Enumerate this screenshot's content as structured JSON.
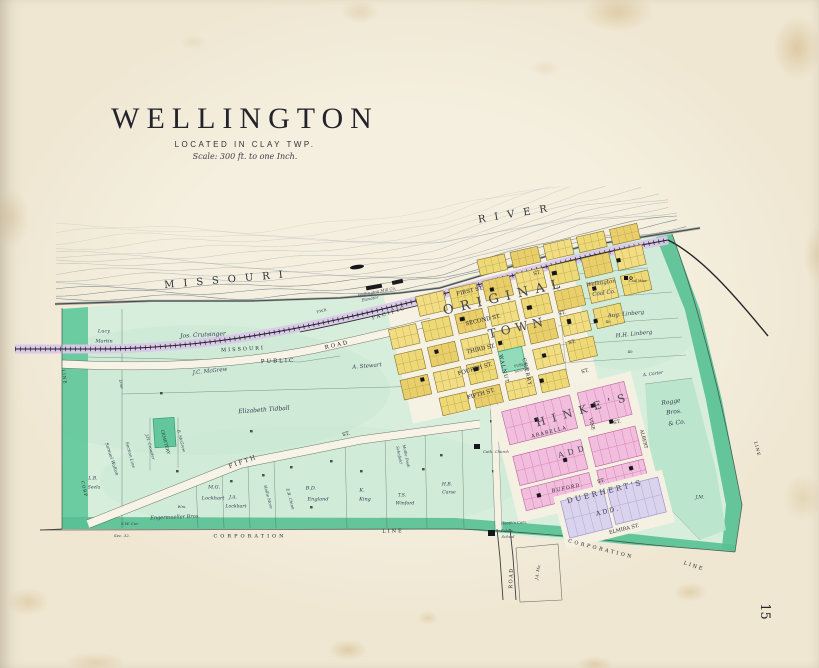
{
  "page": {
    "number": "15"
  },
  "title": {
    "main": "WELLINGTON",
    "located": "LOCATED IN CLAY TWP.",
    "scale": "Scale: 300 ft. to one Inch."
  },
  "map": {
    "colors": {
      "paper": "#f2ebda",
      "water_line": "#86959c",
      "land_green": "#d8eedd",
      "corp_band_green": "#58c094",
      "railroad_band": "#d9c8e8",
      "town_block_yellow": "#eed977",
      "hinkes_pink": "#f2bedd",
      "duerherts_lavender": "#dad3ee",
      "public_square_green": "#93dcbb",
      "cemetery_green": "#63c79b",
      "building_black": "#15151a"
    },
    "labels": [
      {
        "id": "missouri-river",
        "t": "MISSOURI",
        "x": 228,
        "y": 280,
        "r": -5,
        "s": 10,
        "ls": 9,
        "cls": "river"
      },
      {
        "id": "river",
        "t": "RIVER",
        "x": 517,
        "y": 214,
        "r": -9,
        "s": 10,
        "ls": 9,
        "cls": "river"
      },
      {
        "id": "rr-missouri",
        "t": "MISSOURI",
        "x": 243,
        "y": 349,
        "r": -3,
        "s": 5,
        "ls": 2,
        "cls": "small-caps"
      },
      {
        "id": "rr-pacific",
        "t": "PACIFIC",
        "x": 389,
        "y": 313,
        "r": -17,
        "s": 5,
        "ls": 2,
        "cls": "small-caps"
      },
      {
        "id": "fwb",
        "t": "F.W.B.",
        "x": 322,
        "y": 311,
        "r": -15,
        "s": 3.6,
        "cls": "tiny"
      },
      {
        "id": "public-road-1",
        "t": "PUBLIC",
        "x": 278,
        "y": 361,
        "r": -2,
        "s": 5.5,
        "ls": 2,
        "cls": "small-caps"
      },
      {
        "id": "public-road-2",
        "t": "ROAD",
        "x": 337,
        "y": 345,
        "r": -13,
        "s": 5.5,
        "ls": 2,
        "cls": "small-caps"
      },
      {
        "id": "mill",
        "t": "Wellington Mill Co.",
        "x": 377,
        "y": 292,
        "r": -11,
        "s": 4,
        "cls": "tiny-italic"
      },
      {
        "id": "elevator",
        "t": "Elevator",
        "x": 370,
        "y": 299,
        "r": -11,
        "s": 4,
        "cls": "tiny-italic"
      },
      {
        "id": "original",
        "t": "ORIGINAL",
        "x": 505,
        "y": 297,
        "r": -13,
        "s": 13,
        "ls": 7,
        "cls": "bigname"
      },
      {
        "id": "town",
        "t": "TOWN",
        "x": 518,
        "y": 328,
        "r": -13,
        "s": 12,
        "ls": 5,
        "cls": "bigname"
      },
      {
        "id": "st-top",
        "t": "ST.",
        "x": 537,
        "y": 273,
        "r": -13,
        "s": 5,
        "cls": "street"
      },
      {
        "id": "first-st",
        "t": "FIRST ST.",
        "x": 470,
        "y": 291,
        "r": -13,
        "s": 5.5,
        "cls": "street"
      },
      {
        "id": "second-st",
        "t": "SECOND ST.",
        "x": 483,
        "y": 320,
        "r": -13,
        "s": 5.5,
        "cls": "street"
      },
      {
        "id": "third-st",
        "t": "THIRD ST.",
        "x": 481,
        "y": 349,
        "r": -13,
        "s": 5.5,
        "cls": "street"
      },
      {
        "id": "fourth-st",
        "t": "FOURTH ST.",
        "x": 475,
        "y": 369,
        "r": -16,
        "s": 5.5,
        "cls": "street"
      },
      {
        "id": "fifth-st-town",
        "t": "FIFTH ST.",
        "x": 481,
        "y": 394,
        "r": -16,
        "s": 5.5,
        "cls": "street"
      },
      {
        "id": "st-2",
        "t": "ST.",
        "x": 562,
        "y": 313,
        "r": -13,
        "s": 5,
        "cls": "street"
      },
      {
        "id": "st-3",
        "t": "ST.",
        "x": 572,
        "y": 342,
        "r": -13,
        "s": 5,
        "cls": "street"
      },
      {
        "id": "st-4",
        "t": "ST.",
        "x": 585,
        "y": 371,
        "r": -13,
        "s": 5,
        "cls": "street"
      },
      {
        "id": "walnut",
        "t": "WALNUT",
        "x": 504,
        "y": 369,
        "r": 77,
        "s": 5,
        "ls": 1,
        "cls": "street"
      },
      {
        "id": "cherry",
        "t": "CHERRY",
        "x": 527,
        "y": 372,
        "r": 77,
        "s": 5,
        "ls": 1,
        "cls": "street"
      },
      {
        "id": "public-square-1",
        "t": "PUBLIC",
        "x": 521,
        "y": 365,
        "r": -13,
        "s": 3.4,
        "cls": "tiny"
      },
      {
        "id": "public-square-2",
        "t": "SQUARE",
        "x": 522,
        "y": 370,
        "r": -13,
        "s": 3.4,
        "cls": "tiny"
      },
      {
        "id": "lucy",
        "t": "Lucy",
        "x": 104,
        "y": 331,
        "s": 5,
        "cls": "name"
      },
      {
        "id": "martin",
        "t": "Martin",
        "x": 104,
        "y": 341,
        "s": 5,
        "cls": "name"
      },
      {
        "id": "crutsinger",
        "t": "Jos. Crutsinger",
        "x": 203,
        "y": 335,
        "r": -3,
        "s": 6,
        "cls": "name"
      },
      {
        "id": "mcgrew",
        "t": "J.C. McGrew",
        "x": 210,
        "y": 371,
        "r": -6,
        "s": 5.5,
        "cls": "name"
      },
      {
        "id": "stewart",
        "t": "A. Stewart",
        "x": 367,
        "y": 366,
        "r": -5,
        "s": 5.5,
        "cls": "name"
      },
      {
        "id": "tidball",
        "t": "Elizabeth Tidball",
        "x": 264,
        "y": 410,
        "r": -4,
        "s": 6,
        "cls": "name"
      },
      {
        "id": "cemetery",
        "t": "CEMETERY",
        "x": 165,
        "y": 442,
        "r": 75,
        "s": 4.2,
        "cls": "smallcaps-dark"
      },
      {
        "id": "crowder",
        "t": "J.H. Crowder",
        "x": 150,
        "y": 447,
        "r": 75,
        "s": 4,
        "cls": "name"
      },
      {
        "id": "b-mcgrew",
        "t": "B. McGrew",
        "x": 181,
        "y": 441,
        "r": 75,
        "s": 4,
        "cls": "name"
      },
      {
        "id": "walton",
        "t": "Samuel Walton",
        "x": 112,
        "y": 459,
        "r": 72,
        "s": 4.5,
        "cls": "name"
      },
      {
        "id": "section-line",
        "t": "Section Line",
        "x": 130,
        "y": 455,
        "r": 75,
        "s": 4.2,
        "cls": "name"
      },
      {
        "id": "line-n",
        "t": "Line",
        "x": 121,
        "y": 384,
        "r": 80,
        "s": 4.2,
        "cls": "name"
      },
      {
        "id": "lb",
        "t": "L.B.",
        "x": 93,
        "y": 478,
        "s": 4.5,
        "cls": "name"
      },
      {
        "id": "seela",
        "t": "Seela",
        "x": 94,
        "y": 487,
        "s": 4.5,
        "cls": "name"
      },
      {
        "id": "mg",
        "t": "M.G.",
        "x": 214,
        "y": 487,
        "s": 5,
        "cls": "name"
      },
      {
        "id": "lockhart-1",
        "t": "Lockhart",
        "x": 213,
        "y": 498,
        "s": 5,
        "cls": "name"
      },
      {
        "id": "ja",
        "t": "J.A.",
        "x": 233,
        "y": 497,
        "s": 4.6,
        "cls": "name"
      },
      {
        "id": "lockhart-2",
        "t": "Lockhart",
        "x": 236,
        "y": 506,
        "s": 4.6,
        "cls": "name"
      },
      {
        "id": "wm",
        "t": "Wm.",
        "x": 182,
        "y": 507,
        "s": 4,
        "cls": "name"
      },
      {
        "id": "hollie",
        "t": "Hollie More",
        "x": 268,
        "y": 497,
        "r": 75,
        "s": 4,
        "cls": "name"
      },
      {
        "id": "chinn",
        "t": "E.R. Chinn",
        "x": 290,
        "y": 499,
        "r": 75,
        "s": 4,
        "cls": "name"
      },
      {
        "id": "engermueller",
        "t": "Engermueller Bros.",
        "x": 175,
        "y": 517,
        "r": -2,
        "s": 5,
        "cls": "name"
      },
      {
        "id": "sw-cor",
        "t": "S.W. Cor.",
        "x": 130,
        "y": 524,
        "s": 4,
        "cls": "name"
      },
      {
        "id": "sec-32",
        "t": "Sec. 32.",
        "x": 122,
        "y": 536,
        "s": 4,
        "cls": "name"
      },
      {
        "id": "bd",
        "t": "B.D.",
        "x": 311,
        "y": 488,
        "s": 5,
        "cls": "name"
      },
      {
        "id": "england",
        "t": "England",
        "x": 318,
        "y": 499,
        "s": 5,
        "cls": "name"
      },
      {
        "id": "k",
        "t": "K.",
        "x": 362,
        "y": 490,
        "s": 5,
        "cls": "name"
      },
      {
        "id": "king",
        "t": "King",
        "x": 365,
        "y": 499,
        "s": 5,
        "cls": "name"
      },
      {
        "id": "ts",
        "t": "T.S.",
        "x": 402,
        "y": 495,
        "s": 4.6,
        "cls": "name"
      },
      {
        "id": "winford",
        "t": "Winford",
        "x": 405,
        "y": 503,
        "s": 4.6,
        "cls": "name"
      },
      {
        "id": "hb",
        "t": "H.B.",
        "x": 447,
        "y": 484,
        "s": 4.6,
        "cls": "name"
      },
      {
        "id": "carse",
        "t": "Carse",
        "x": 449,
        "y": 492,
        "s": 4.6,
        "cls": "name"
      },
      {
        "id": "schofield",
        "t": "Schofield",
        "x": 399,
        "y": 455,
        "r": 78,
        "s": 3.8,
        "cls": "name"
      },
      {
        "id": "doak",
        "t": "Mollie Doak",
        "x": 406,
        "y": 456,
        "r": 78,
        "s": 3.8,
        "cls": "name"
      },
      {
        "id": "fifth-w",
        "t": "FIFTH",
        "x": 243,
        "y": 462,
        "r": -20,
        "s": 6,
        "ls": 2,
        "cls": "street"
      },
      {
        "id": "st-w",
        "t": "ST.",
        "x": 346,
        "y": 434,
        "r": -12,
        "s": 5,
        "cls": "street"
      },
      {
        "id": "corp-s",
        "t": "CORPORATION",
        "x": 250,
        "y": 536,
        "s": 5,
        "ls": 3,
        "cls": "small-caps"
      },
      {
        "id": "line-s",
        "t": "LINE",
        "x": 393,
        "y": 531,
        "r": -2,
        "s": 5,
        "ls": 2,
        "cls": "small-caps"
      },
      {
        "id": "corp-se",
        "t": "CORPORATION",
        "x": 601,
        "y": 549,
        "r": 14,
        "s": 5,
        "ls": 2.5,
        "cls": "small-caps"
      },
      {
        "id": "line-se",
        "t": "LINE",
        "x": 694,
        "y": 566,
        "r": 18,
        "s": 5,
        "ls": 2,
        "cls": "small-caps"
      },
      {
        "id": "corp-w",
        "t": "CORP",
        "x": 84,
        "y": 489,
        "r": 78,
        "s": 4.2,
        "ls": 1,
        "cls": "small-caps"
      },
      {
        "id": "line-w",
        "t": "LINE",
        "x": 64,
        "y": 377,
        "r": 82,
        "s": 4.2,
        "ls": 1,
        "cls": "small-caps"
      },
      {
        "id": "line-e",
        "t": "LINE",
        "x": 757,
        "y": 449,
        "r": 76,
        "s": 4.2,
        "ls": 1,
        "cls": "small-caps"
      },
      {
        "id": "wellington-coal-1",
        "t": "Wellington",
        "x": 601,
        "y": 283,
        "r": -8,
        "s": 5.5,
        "cls": "name"
      },
      {
        "id": "wellington-coal-2",
        "t": "Coal Co.",
        "x": 604,
        "y": 293,
        "r": -8,
        "s": 5.5,
        "cls": "name"
      },
      {
        "id": "coal-mine",
        "t": "Coal Mine",
        "x": 638,
        "y": 281,
        "s": 3.4,
        "cls": "tiny"
      },
      {
        "id": "aug-linberg",
        "t": "Aug. Linberg",
        "x": 626,
        "y": 314,
        "r": -6,
        "s": 5.5,
        "cls": "name"
      },
      {
        "id": "hh-linberg",
        "t": "H.H. Linberg",
        "x": 634,
        "y": 334,
        "r": -6,
        "s": 5.5,
        "cls": "name"
      },
      {
        "id": "carter",
        "t": "A. Carter",
        "x": 653,
        "y": 374,
        "r": -8,
        "s": 4.4,
        "cls": "name"
      },
      {
        "id": "rogge-1",
        "t": "Rogge",
        "x": 671,
        "y": 402,
        "r": -8,
        "s": 6,
        "cls": "name"
      },
      {
        "id": "rogge-2",
        "t": "Bros.",
        "x": 674,
        "y": 412,
        "r": -8,
        "s": 6,
        "cls": "name"
      },
      {
        "id": "rogge-3",
        "t": "& Co.",
        "x": 677,
        "y": 423,
        "r": -8,
        "s": 6,
        "cls": "name"
      },
      {
        "id": "jm",
        "t": "J.M.",
        "x": 700,
        "y": 497,
        "s": 4.6,
        "cls": "name"
      },
      {
        "id": "forty-1",
        "t": "40",
        "x": 608,
        "y": 322,
        "s": 4,
        "cls": "tiny"
      },
      {
        "id": "forty-2",
        "t": "40",
        "x": 630,
        "y": 352,
        "s": 4,
        "cls": "tiny"
      },
      {
        "id": "hinkes",
        "t": "HINKE'S",
        "x": 584,
        "y": 410,
        "r": -16,
        "s": 11,
        "ls": 7,
        "cls": "bigname"
      },
      {
        "id": "hinkes-add",
        "t": "ADD",
        "x": 573,
        "y": 452,
        "r": -16,
        "s": 8,
        "ls": 4,
        "cls": "bigname"
      },
      {
        "id": "arabella",
        "t": "ARABELLA",
        "x": 549,
        "y": 432,
        "r": -14,
        "s": 5,
        "ls": 1,
        "cls": "street"
      },
      {
        "id": "arabella-st",
        "t": "ST.",
        "x": 617,
        "y": 422,
        "r": -14,
        "s": 5,
        "cls": "street"
      },
      {
        "id": "vine",
        "t": "VINE",
        "x": 592,
        "y": 424,
        "r": 76,
        "s": 4.6,
        "cls": "street"
      },
      {
        "id": "albert",
        "t": "ALBERT",
        "x": 644,
        "y": 439,
        "r": 76,
        "s": 4.6,
        "cls": "street"
      },
      {
        "id": "buford",
        "t": "BUFORD",
        "x": 566,
        "y": 488,
        "r": -12,
        "s": 5,
        "ls": 1,
        "cls": "street"
      },
      {
        "id": "buford-st",
        "t": "ST.",
        "x": 601,
        "y": 481,
        "r": -12,
        "s": 5,
        "cls": "street"
      },
      {
        "id": "duerherts",
        "t": "DUERHERT'S",
        "x": 605,
        "y": 492,
        "r": -14,
        "s": 7.5,
        "ls": 2.5,
        "cls": "bigname"
      },
      {
        "id": "duerherts-add",
        "t": "ADD.",
        "x": 608,
        "y": 511,
        "r": -14,
        "s": 6.5,
        "ls": 2,
        "cls": "bigname"
      },
      {
        "id": "elmira-st",
        "t": "ELMIRA ST.",
        "x": 624,
        "y": 529,
        "r": -14,
        "s": 5,
        "cls": "street"
      },
      {
        "id": "cath-church",
        "t": "Cath. Church",
        "x": 496,
        "y": 452,
        "s": 3.8,
        "cls": "tiny-italic"
      },
      {
        "id": "heaths-cem",
        "t": "Heath's Cem.",
        "x": 514,
        "y": 523,
        "r": -3,
        "s": 3.8,
        "cls": "tiny-italic"
      },
      {
        "id": "public-school-1",
        "t": "Public",
        "x": 507,
        "y": 531,
        "s": 3.8,
        "cls": "tiny-italic"
      },
      {
        "id": "public-school-2",
        "t": "School",
        "x": 508,
        "y": 537,
        "s": 3.8,
        "cls": "tiny-italic"
      },
      {
        "id": "road-s",
        "t": "ROAD",
        "x": 511,
        "y": 578,
        "r": -88,
        "s": 5,
        "ls": 1.5,
        "cls": "small-caps"
      },
      {
        "id": "ja-ma",
        "t": "J.A. Ma.",
        "x": 538,
        "y": 572,
        "r": -80,
        "s": 4,
        "cls": "name"
      }
    ]
  }
}
